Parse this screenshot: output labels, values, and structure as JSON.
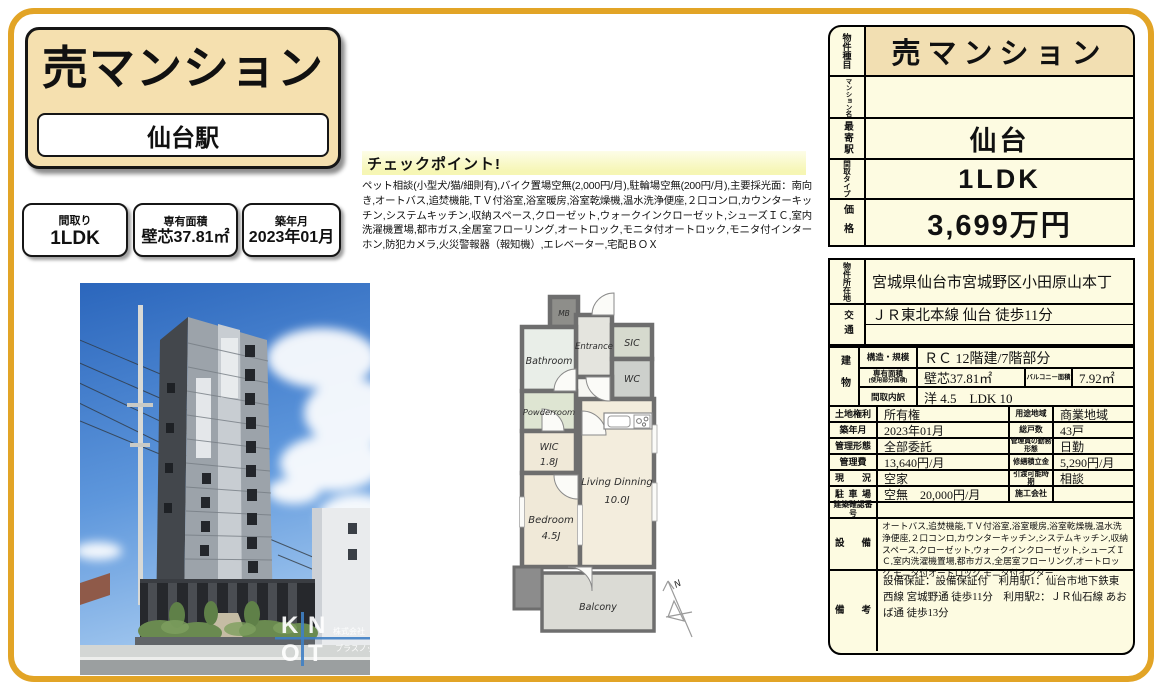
{
  "colors": {
    "frame": "#E2A426",
    "card_bg": "#F5E0AF",
    "panel_bg": "#FDFBE1",
    "header_bg": "#F2DFB2",
    "knot_blue": "#3F7FC4"
  },
  "title_card": {
    "property_type": "売マンション",
    "station": "仙台駅"
  },
  "summary": [
    {
      "label": "間取り",
      "value": "1LDK"
    },
    {
      "label": "専有面積",
      "value": "壁芯37.81㎡"
    },
    {
      "label": "築年月",
      "value": "2023年01月"
    }
  ],
  "checkpoint": {
    "title": "チェックポイント!",
    "body": "ペット相談(小型犬/猫/細則有),バイク置場空無(2,000円/月),駐輪場空無(200円/月),主要採光面：南向き,オートバス,追焚機能,ＴＶ付浴室,浴室暖房,浴室乾燥機,温水洗浄便座,２口コンロ,カウンターキッチン,システムキッチン,収納スペース,クローゼット,ウォークインクローゼット,シューズＩＣ,室内洗濯機置場,都市ガス,全居室フローリング,オートロック,モニタ付オートロック,モニタ付インターホン,防犯カメラ,火災警報器（報知機）,エレベーター,宅配ＢＯＸ"
  },
  "photo": {
    "watermark": {
      "k": "K",
      "n": "N",
      "o": "O",
      "t": "T",
      "company_line1": "株式会社",
      "company_line2": "プラスノット"
    }
  },
  "floorplan": {
    "mb": "MB",
    "bathroom": "Bathroom",
    "entrance": "Entrance",
    "sic": "SIC",
    "wc": "WC",
    "powderroom": "Powderroom",
    "wic": "WIC",
    "wic_size": "1.8J",
    "bedroom": "Bedroom",
    "bedroom_size": "4.5J",
    "living": "Living Dinning",
    "living_size": "10.0J",
    "balcony": "Balcony",
    "north": "N"
  },
  "table": {
    "block_a": [
      {
        "label": "物件種目",
        "value": "売マンション"
      },
      {
        "label": "マンション名",
        "value": ""
      },
      {
        "label": "最寄駅",
        "value": "仙台"
      },
      {
        "label": "間取タイプ",
        "value": "1LDK"
      },
      {
        "label": "価格",
        "value": "3,699万円"
      }
    ],
    "address": {
      "label": "物件所在地",
      "value": "宮城県仙台市宮城野区小田原山本丁"
    },
    "access": {
      "label": "交通",
      "value1": "ＪＲ東北本線 仙台 徒歩11分",
      "value2": ""
    },
    "building": {
      "label": "建物",
      "structure": {
        "label": "構造・規模",
        "value": "ＲＣ 12階建/7階部分"
      },
      "area": {
        "label": "専有面積",
        "sublabel": "(使用部分面積)",
        "value": "壁芯37.81㎡",
        "label2": "バルコニー面積",
        "value2": "7.92㎡"
      },
      "layout": {
        "label": "間取内訳",
        "value": "洋 4.5　LDK 10"
      }
    },
    "detail_rows": [
      {
        "label": "土地権利",
        "value": "所有権",
        "label2": "用途地域",
        "value2": "商業地域"
      },
      {
        "label": "築年月",
        "value": "2023年01月",
        "label2": "総戸数",
        "value2": "43戸"
      },
      {
        "label": "管理形態",
        "value": "全部委託",
        "label2": "管理員の勤務形態",
        "value2": "日勤"
      },
      {
        "label": "管理費",
        "value": "13,640円/月",
        "label2": "修繕積立金",
        "value2": "5,290円/月"
      },
      {
        "label": "現況",
        "value": "空家",
        "label2": "引渡可能時期",
        "value2": "相談"
      },
      {
        "label": "駐車場",
        "value": "空無　20,000円/月",
        "label2": "施工会社",
        "value2": ""
      }
    ],
    "confirmation": {
      "label": "建築確認番号",
      "value": ""
    },
    "equipment": {
      "label": "設備",
      "value": "オートバス,追焚機能,ＴＶ付浴室,浴室暖房,浴室乾燥機,温水洗浄便座,２口コンロ,カウンターキッチン,システムキッチン,収納スペース,クローゼット,ウォークインクローゼット,シューズＩＣ,室内洗濯機置場,都市ガス,全居室フローリング,オートロック,モニタ付オートロック,モニタ付インター.."
    },
    "remarks": {
      "label": "備考",
      "value": "設備保証：設備保証付　利用駅1：仙台市地下鉄東西線 宮城野通 徒歩11分　利用駅2：ＪＲ仙石線 あおば通 徒歩13分"
    }
  }
}
